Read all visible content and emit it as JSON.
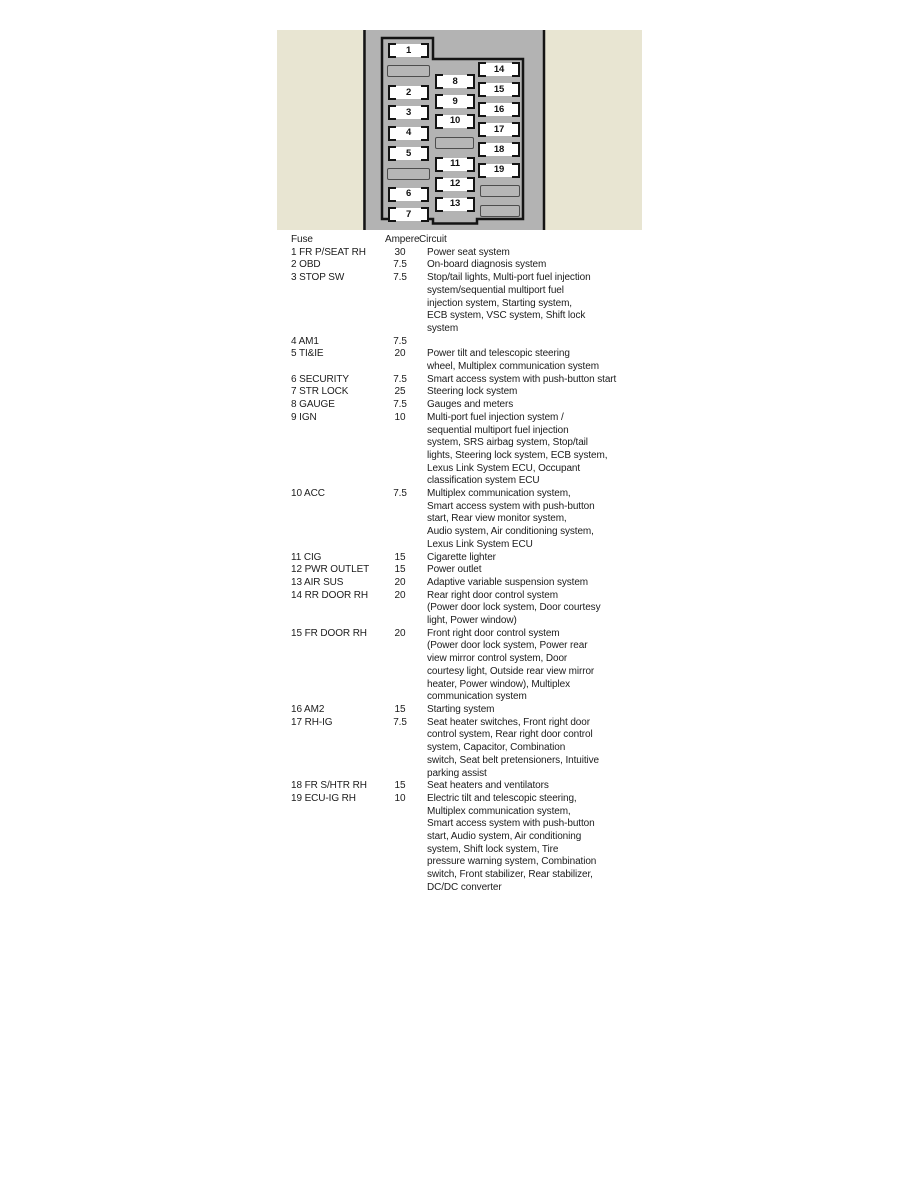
{
  "diagram": {
    "background_color": "#e8e5d2",
    "panel_color": "#b3b3b3",
    "outline_color": "#141414",
    "fuse_fill": "#ffffff",
    "blank_fill": "#b6b6b6",
    "fuse_numbers": [
      "1",
      "2",
      "3",
      "4",
      "5",
      "6",
      "7",
      "8",
      "9",
      "10",
      "11",
      "12",
      "13",
      "14",
      "15",
      "16",
      "17",
      "18",
      "19"
    ]
  },
  "table": {
    "headers": {
      "fuse": "Fuse",
      "ampere": "Ampere",
      "circuit": "Circuit"
    },
    "rows": [
      {
        "fuse": "1 FR P/SEAT RH",
        "ampere": "30",
        "circuit": "Power seat system"
      },
      {
        "fuse": "2 OBD",
        "ampere": "7.5",
        "circuit": "On-board diagnosis system"
      },
      {
        "fuse": "3 STOP SW",
        "ampere": "7.5",
        "circuit": "Stop/tail lights, Multi-port fuel injection\nsystem/sequential multiport fuel\ninjection system, Starting system,\nECB system, VSC system, Shift lock\nsystem"
      },
      {
        "fuse": "4 AM1",
        "ampere": "7.5",
        "circuit": ""
      },
      {
        "fuse": "5 TI&IE",
        "ampere": "20",
        "circuit": "Power tilt and telescopic steering\nwheel, Multiplex communication system"
      },
      {
        "fuse": "6 SECURITY",
        "ampere": "7.5",
        "circuit": "Smart access system with push-button start"
      },
      {
        "fuse": "7 STR LOCK",
        "ampere": "25",
        "circuit": "Steering lock system"
      },
      {
        "fuse": "8 GAUGE",
        "ampere": "7.5",
        "circuit": "Gauges and meters"
      },
      {
        "fuse": "9 IGN",
        "ampere": "10",
        "circuit": "Multi-port fuel injection system /\nsequential multiport fuel injection\nsystem, SRS airbag system, Stop/tail\nlights, Steering lock system, ECB system,\nLexus Link System ECU, Occupant\nclassification system ECU"
      },
      {
        "fuse": "10 ACC",
        "ampere": "7.5",
        "circuit": "Multiplex communication system,\nSmart access system with push-button\nstart, Rear view monitor system,\nAudio system, Air conditioning system,\nLexus Link System ECU"
      },
      {
        "fuse": "11 CIG",
        "ampere": "15",
        "circuit": "Cigarette lighter"
      },
      {
        "fuse": "12 PWR OUTLET",
        "ampere": "15",
        "circuit": "Power outlet"
      },
      {
        "fuse": "13 AIR SUS",
        "ampere": "20",
        "circuit": "Adaptive variable suspension system"
      },
      {
        "fuse": "14 RR DOOR RH",
        "ampere": "20",
        "circuit": "Rear right door control system\n(Power door lock system, Door courtesy\nlight, Power window)"
      },
      {
        "fuse": "15 FR DOOR RH",
        "ampere": "20",
        "circuit": "Front right door control system\n(Power door lock system, Power rear\nview mirror control system, Door\ncourtesy light, Outside rear view mirror\nheater, Power window), Multiplex\ncommunication system"
      },
      {
        "fuse": "16 AM2",
        "ampere": "15",
        "circuit": "Starting system"
      },
      {
        "fuse": "17 RH-IG",
        "ampere": "7.5",
        "circuit": "Seat heater switches, Front right door\ncontrol system, Rear right door control\nsystem, Capacitor, Combination\nswitch, Seat belt pretensioners, Intuitive\nparking assist"
      },
      {
        "fuse": "18 FR S/HTR RH",
        "ampere": "15",
        "circuit": "Seat heaters and ventilators"
      },
      {
        "fuse": "19 ECU-IG RH",
        "ampere": "10",
        "circuit": "Electric tilt and telescopic steering,\nMultiplex communication system,\nSmart access system with push-button\nstart, Audio system, Air conditioning\nsystem, Shift lock system, Tire\npressure warning system, Combination\nswitch, Front stabilizer, Rear stabilizer,\nDC/DC converter"
      }
    ]
  }
}
